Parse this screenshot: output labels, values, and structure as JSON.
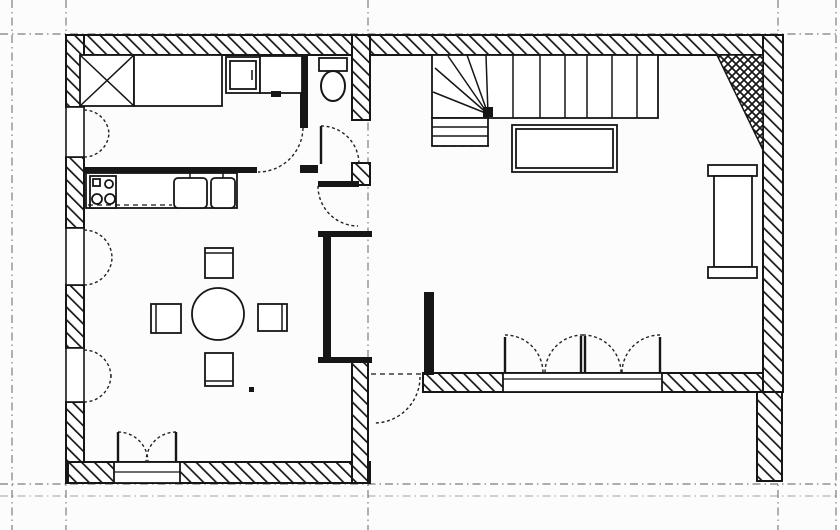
{
  "plan": {
    "canvas": {
      "width": 840,
      "height": 530,
      "background": "#fcfcfc",
      "ink": "#161616",
      "grid_color": "#4a4a4a"
    },
    "grid": {
      "verticals": [
        12,
        66,
        368,
        778,
        836
      ],
      "horizontals": [
        {
          "y": 34,
          "o": 0.9
        },
        {
          "y": 484,
          "o": 0.9
        },
        {
          "y": 496,
          "o": 0.5
        }
      ]
    },
    "hatched_walls": [
      {
        "n": "wall-top",
        "v": [
          68,
          35,
          715,
          20
        ]
      },
      {
        "n": "wall-left-a",
        "v": [
          66,
          35,
          18,
          72
        ]
      },
      {
        "n": "wall-left-b",
        "v": [
          66,
          157,
          18,
          71
        ]
      },
      {
        "n": "wall-left-c",
        "v": [
          66,
          285,
          18,
          63
        ]
      },
      {
        "n": "wall-left-d",
        "v": [
          66,
          402,
          18,
          81
        ]
      },
      {
        "n": "wall-bottom-left-room",
        "v": [
          68,
          462,
          302,
          21
        ]
      },
      {
        "n": "wall-middle-a",
        "v": [
          352,
          35,
          18,
          85
        ]
      },
      {
        "n": "wall-middle-b",
        "v": [
          352,
          163,
          18,
          22
        ]
      },
      {
        "n": "wall-middle-c",
        "v": [
          352,
          360,
          16,
          123
        ]
      },
      {
        "n": "wall-right",
        "v": [
          763,
          35,
          20,
          357
        ]
      },
      {
        "n": "wall-right-stub",
        "v": [
          757,
          392,
          25,
          89
        ]
      },
      {
        "n": "wall-bottom-living",
        "v": [
          423,
          373,
          340,
          19
        ]
      }
    ],
    "chimney": {
      "n": "chimney-flue",
      "points": "717,55 763,55 763,150"
    },
    "window_frames": [
      {
        "n": "window-frame-1",
        "v": [
          66,
          107,
          18,
          50
        ]
      },
      {
        "n": "window-frame-2",
        "v": [
          66,
          228,
          18,
          57
        ]
      },
      {
        "n": "window-frame-3",
        "v": [
          66,
          348,
          18,
          54
        ]
      }
    ],
    "sills": [
      {
        "n": "door-sill-left-room",
        "rect": [
          114,
          462,
          66,
          21
        ],
        "line_y": 472
      },
      {
        "n": "door-sill-living",
        "rect": [
          503,
          373,
          159,
          19
        ],
        "line_y": 379
      }
    ],
    "solid_bars": [
      {
        "n": "partition-kitchen",
        "v": [
          84,
          167,
          173,
          6
        ]
      },
      {
        "n": "wc-wall-left",
        "v": [
          300,
          55,
          8,
          73
        ]
      },
      {
        "n": "wc-wall-stub",
        "v": [
          300,
          165,
          18,
          8
        ]
      },
      {
        "n": "hall-door-leaf",
        "v": [
          318,
          181,
          41,
          6
        ]
      },
      {
        "n": "niche-top",
        "v": [
          318,
          231,
          54,
          6
        ]
      },
      {
        "n": "niche-left",
        "v": [
          323,
          237,
          8,
          122
        ]
      },
      {
        "n": "niche-bottom",
        "v": [
          318,
          357,
          54,
          6
        ]
      },
      {
        "n": "hall-stub-wall",
        "v": [
          424,
          292,
          10,
          83
        ]
      }
    ],
    "door_arcs": [
      {
        "n": "door-arc-kitchen",
        "d": "M 303 128 A 45 45 0 0 1 258 172"
      },
      {
        "n": "door-arc-wc",
        "d": "M 321 126 A 38 38 0 0 1 359 164"
      },
      {
        "n": "door-arc-hall-living",
        "d": "M 318 186 A 40 40 0 0 0 358 226"
      },
      {
        "n": "door-arc-terrace",
        "d": "M 420 377 A 46 46 0 0 1 374 423"
      },
      {
        "n": "door-arc-french-l1",
        "d": "M 505 335 A 38 38 0 0 1 543 373"
      },
      {
        "n": "door-arc-french-l2",
        "d": "M 583 335 A 38 38 0 0 0 545 373"
      },
      {
        "n": "door-arc-french-r1",
        "d": "M 583 335 A 38 38 0 0 1 621 373"
      },
      {
        "n": "door-arc-french-r2",
        "d": "M 660 335 A 38 38 0 0 0 622 373"
      },
      {
        "n": "door-arc-garden-a",
        "d": "M 118 432 A 30 30 0 0 1 148 462"
      },
      {
        "n": "door-arc-garden-b",
        "d": "M 176 432 A 30 30 0 0 0 146 462"
      },
      {
        "n": "window-arc-1a",
        "d": "M 84 110 A 25 25 0 0 1 109 135"
      },
      {
        "n": "window-arc-1b",
        "d": "M 84 157 A 25 25 0 0 0 109 132"
      },
      {
        "n": "window-arc-2a",
        "d": "M 84 230 A 28 28 0 0 1 112 258"
      },
      {
        "n": "window-arc-2b",
        "d": "M 84 285 A 28 28 0 0 0 112 257"
      },
      {
        "n": "window-arc-3a",
        "d": "M 84 350 A 27 27 0 0 1 111 377"
      },
      {
        "n": "window-arc-3b",
        "d": "M 84 402 A 27 27 0 0 0 111 375"
      }
    ],
    "door_leaves": [
      {
        "n": "wc-door-leaf",
        "v": [
          321,
          126,
          321,
          164
        ]
      },
      {
        "n": "french-leaf-left",
        "v": [
          505,
          337,
          505,
          373
        ]
      },
      {
        "n": "french-leaf-center-a",
        "v": [
          581,
          336,
          581,
          373
        ]
      },
      {
        "n": "french-leaf-center-b",
        "v": [
          585,
          336,
          585,
          373
        ]
      },
      {
        "n": "french-leaf-right",
        "v": [
          660,
          337,
          660,
          373
        ]
      },
      {
        "n": "garden-leaf-a",
        "v": [
          118,
          432,
          118,
          462
        ]
      },
      {
        "n": "garden-leaf-b",
        "v": [
          176,
          432,
          176,
          462
        ]
      }
    ],
    "furniture": [
      {
        "n": "closet-x",
        "t": "rect",
        "v": [
          80,
          55,
          54,
          51
        ]
      },
      {
        "n": "closet-x-diag-1",
        "t": "line",
        "v": [
          80,
          55,
          134,
          106
        ]
      },
      {
        "n": "closet-x-diag-2",
        "t": "line",
        "v": [
          134,
          55,
          80,
          106
        ]
      },
      {
        "n": "wardrobe",
        "t": "rect",
        "v": [
          134,
          55,
          88,
          51
        ]
      },
      {
        "n": "washbasin",
        "t": "rect",
        "v": [
          226,
          57,
          34,
          36
        ]
      },
      {
        "n": "washbasin-inner",
        "t": "rect",
        "v": [
          230,
          61,
          26,
          28
        ]
      },
      {
        "n": "washbasin-tap",
        "t": "line",
        "v": [
          252,
          70,
          252,
          80
        ]
      },
      {
        "n": "worktop-upper",
        "t": "rect",
        "v": [
          260,
          56,
          42,
          37
        ]
      },
      {
        "n": "worktop-handle",
        "t": "rect",
        "v": [
          271,
          91,
          10,
          6
        ],
        "f": 1
      },
      {
        "n": "toilet-tank",
        "t": "rect",
        "v": [
          319,
          58,
          28,
          13
        ]
      },
      {
        "n": "toilet-bowl",
        "t": "ellipse",
        "v": [
          333,
          86,
          12,
          15
        ]
      },
      {
        "n": "kitchen-counter",
        "t": "rect",
        "v": [
          86,
          173,
          151,
          35
        ]
      },
      {
        "n": "stove",
        "t": "rect",
        "v": [
          90,
          176,
          26,
          32
        ]
      },
      {
        "n": "stove-plate",
        "t": "rect",
        "v": [
          93,
          179,
          7,
          7
        ]
      },
      {
        "n": "stove-burner-a",
        "t": "circle",
        "v": [
          109,
          184,
          4
        ]
      },
      {
        "n": "stove-burner-b",
        "t": "circle",
        "v": [
          97,
          199,
          5
        ]
      },
      {
        "n": "stove-burner-c",
        "t": "circle",
        "v": [
          110,
          199,
          5
        ]
      },
      {
        "n": "counter-front-edge",
        "t": "dline",
        "v": [
          88,
          205,
          172,
          205
        ]
      },
      {
        "n": "sink-basin-left",
        "t": "rrect",
        "v": [
          174,
          178,
          33,
          30
        ]
      },
      {
        "n": "sink-tap-left",
        "t": "line",
        "v": [
          190,
          171,
          190,
          178
        ]
      },
      {
        "n": "sink-basin-right",
        "t": "rrect",
        "v": [
          211,
          178,
          24,
          30
        ]
      },
      {
        "n": "sink-tap-right",
        "t": "line",
        "v": [
          223,
          171,
          223,
          178
        ]
      },
      {
        "n": "dining-table",
        "t": "circle",
        "v": [
          218,
          314,
          26
        ]
      },
      {
        "n": "chair-north",
        "t": "rect",
        "v": [
          205,
          248,
          28,
          30
        ]
      },
      {
        "n": "chair-north-back",
        "t": "line",
        "v": [
          205,
          253,
          233,
          253
        ]
      },
      {
        "n": "chair-south",
        "t": "rect",
        "v": [
          205,
          353,
          28,
          33
        ]
      },
      {
        "n": "chair-south-back",
        "t": "line",
        "v": [
          205,
          381,
          233,
          381
        ]
      },
      {
        "n": "chair-west",
        "t": "rect",
        "v": [
          151,
          304,
          30,
          29
        ]
      },
      {
        "n": "chair-west-back",
        "t": "line",
        "v": [
          156,
          304,
          156,
          333
        ]
      },
      {
        "n": "chair-east",
        "t": "rect",
        "v": [
          258,
          304,
          29,
          27
        ]
      },
      {
        "n": "chair-east-back",
        "t": "line",
        "v": [
          282,
          304,
          282,
          331
        ]
      },
      {
        "n": "floor-mark",
        "t": "rect",
        "v": [
          249,
          387,
          5,
          5
        ],
        "f": 1
      },
      {
        "n": "stair-body",
        "t": "rect",
        "v": [
          432,
          55,
          226,
          63
        ]
      },
      {
        "n": "stair-riser-1",
        "t": "line",
        "v": [
          513,
          55,
          513,
          118
        ]
      },
      {
        "n": "stair-riser-2",
        "t": "line",
        "v": [
          540,
          55,
          540,
          118
        ]
      },
      {
        "n": "stair-riser-3",
        "t": "line",
        "v": [
          565,
          55,
          565,
          118
        ]
      },
      {
        "n": "stair-riser-4",
        "t": "line",
        "v": [
          587,
          55,
          587,
          118
        ]
      },
      {
        "n": "stair-riser-5",
        "t": "line",
        "v": [
          612,
          55,
          612,
          118
        ]
      },
      {
        "n": "stair-riser-6",
        "t": "line",
        "v": [
          637,
          55,
          637,
          118
        ]
      },
      {
        "n": "stair-winder-1",
        "t": "line",
        "v": [
          488,
          114,
          433,
          92
        ]
      },
      {
        "n": "stair-winder-2",
        "t": "line",
        "v": [
          488,
          114,
          435,
          68
        ]
      },
      {
        "n": "stair-winder-3",
        "t": "line",
        "v": [
          488,
          114,
          448,
          56
        ]
      },
      {
        "n": "stair-winder-4",
        "t": "line",
        "v": [
          488,
          114,
          467,
          55
        ]
      },
      {
        "n": "stair-winder-5",
        "t": "line",
        "v": [
          488,
          114,
          486,
          55
        ]
      },
      {
        "n": "stair-newel",
        "t": "rect",
        "v": [
          483,
          107,
          10,
          10
        ],
        "f": 1
      },
      {
        "n": "stair-landing",
        "t": "rect",
        "v": [
          432,
          118,
          56,
          28
        ]
      },
      {
        "n": "stair-landing-tread-1",
        "t": "line",
        "v": [
          432,
          127,
          488,
          127
        ]
      },
      {
        "n": "stair-landing-tread-2",
        "t": "line",
        "v": [
          432,
          136,
          488,
          136
        ]
      },
      {
        "n": "stair-landing-edge",
        "t": "dline",
        "v": [
          433,
          146,
          489,
          146
        ]
      },
      {
        "n": "sofa-table",
        "t": "rect",
        "v": [
          512,
          125,
          105,
          47
        ]
      },
      {
        "n": "sofa-table-inner",
        "t": "rect",
        "v": [
          516,
          129,
          97,
          39
        ]
      },
      {
        "n": "radiator-cap-top",
        "t": "rect",
        "v": [
          708,
          165,
          49,
          11
        ]
      },
      {
        "n": "radiator-body",
        "t": "rect",
        "v": [
          714,
          176,
          38,
          91
        ]
      },
      {
        "n": "radiator-cap-bottom",
        "t": "rect",
        "v": [
          708,
          267,
          49,
          11
        ]
      },
      {
        "n": "hall-axis-mark",
        "t": "dline",
        "v": [
          371,
          374,
          421,
          374
        ]
      }
    ]
  }
}
